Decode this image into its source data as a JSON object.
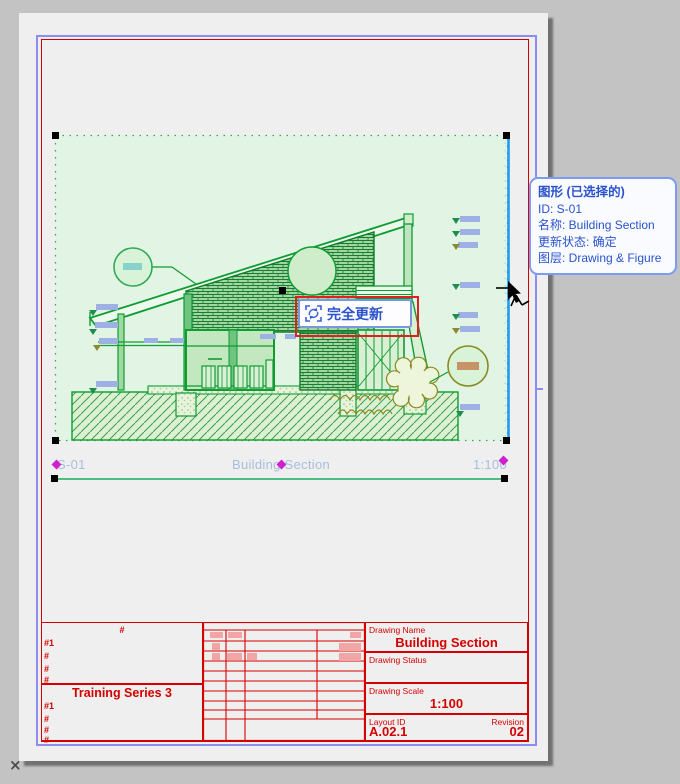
{
  "window": {
    "background_color": "#c3c3c3",
    "close_mark": "×"
  },
  "layout_page": {
    "paper_color": "#efefef",
    "outer_frame_color": "#8d8dee",
    "inner_frame_color": "#d40000"
  },
  "selection_tooltip": {
    "title": "图形 (已选择的)",
    "lines": [
      "ID: S-01",
      "名称: Building Section",
      "更新状态: 确定",
      "图层: Drawing & Figure"
    ],
    "text_color": "#2a52cc"
  },
  "update_button": {
    "label": "完全更新",
    "icon": "full-update-icon",
    "accent_color": "#2a52cc",
    "highlight_border_color": "#e02020"
  },
  "drawing": {
    "id": "S-01",
    "name": "Building Section",
    "scale": "1:100",
    "selection_fill": "#e2f5e4",
    "line_color": "#0f9c33",
    "anchor_diamond_color": "#cf1fcf",
    "clip_edge_color": "#1f9bf0"
  },
  "title_block": {
    "line_color": "#d40000",
    "header_hash": "#",
    "row1_labels": [
      "#1",
      "#",
      "#",
      "#"
    ],
    "series_title": "Training Series 3",
    "row2_labels": [
      "#1",
      "#",
      "#",
      "#"
    ],
    "drawing_name_label": "Drawing Name",
    "drawing_name": "Building Section",
    "drawing_status_label": "Drawing Status",
    "drawing_status": "",
    "drawing_scale_label": "Drawing Scale",
    "drawing_scale": "1:100",
    "layout_id_label": "Layout ID",
    "layout_id": "A.02.1",
    "revision_label": "Revision",
    "revision": "02"
  }
}
